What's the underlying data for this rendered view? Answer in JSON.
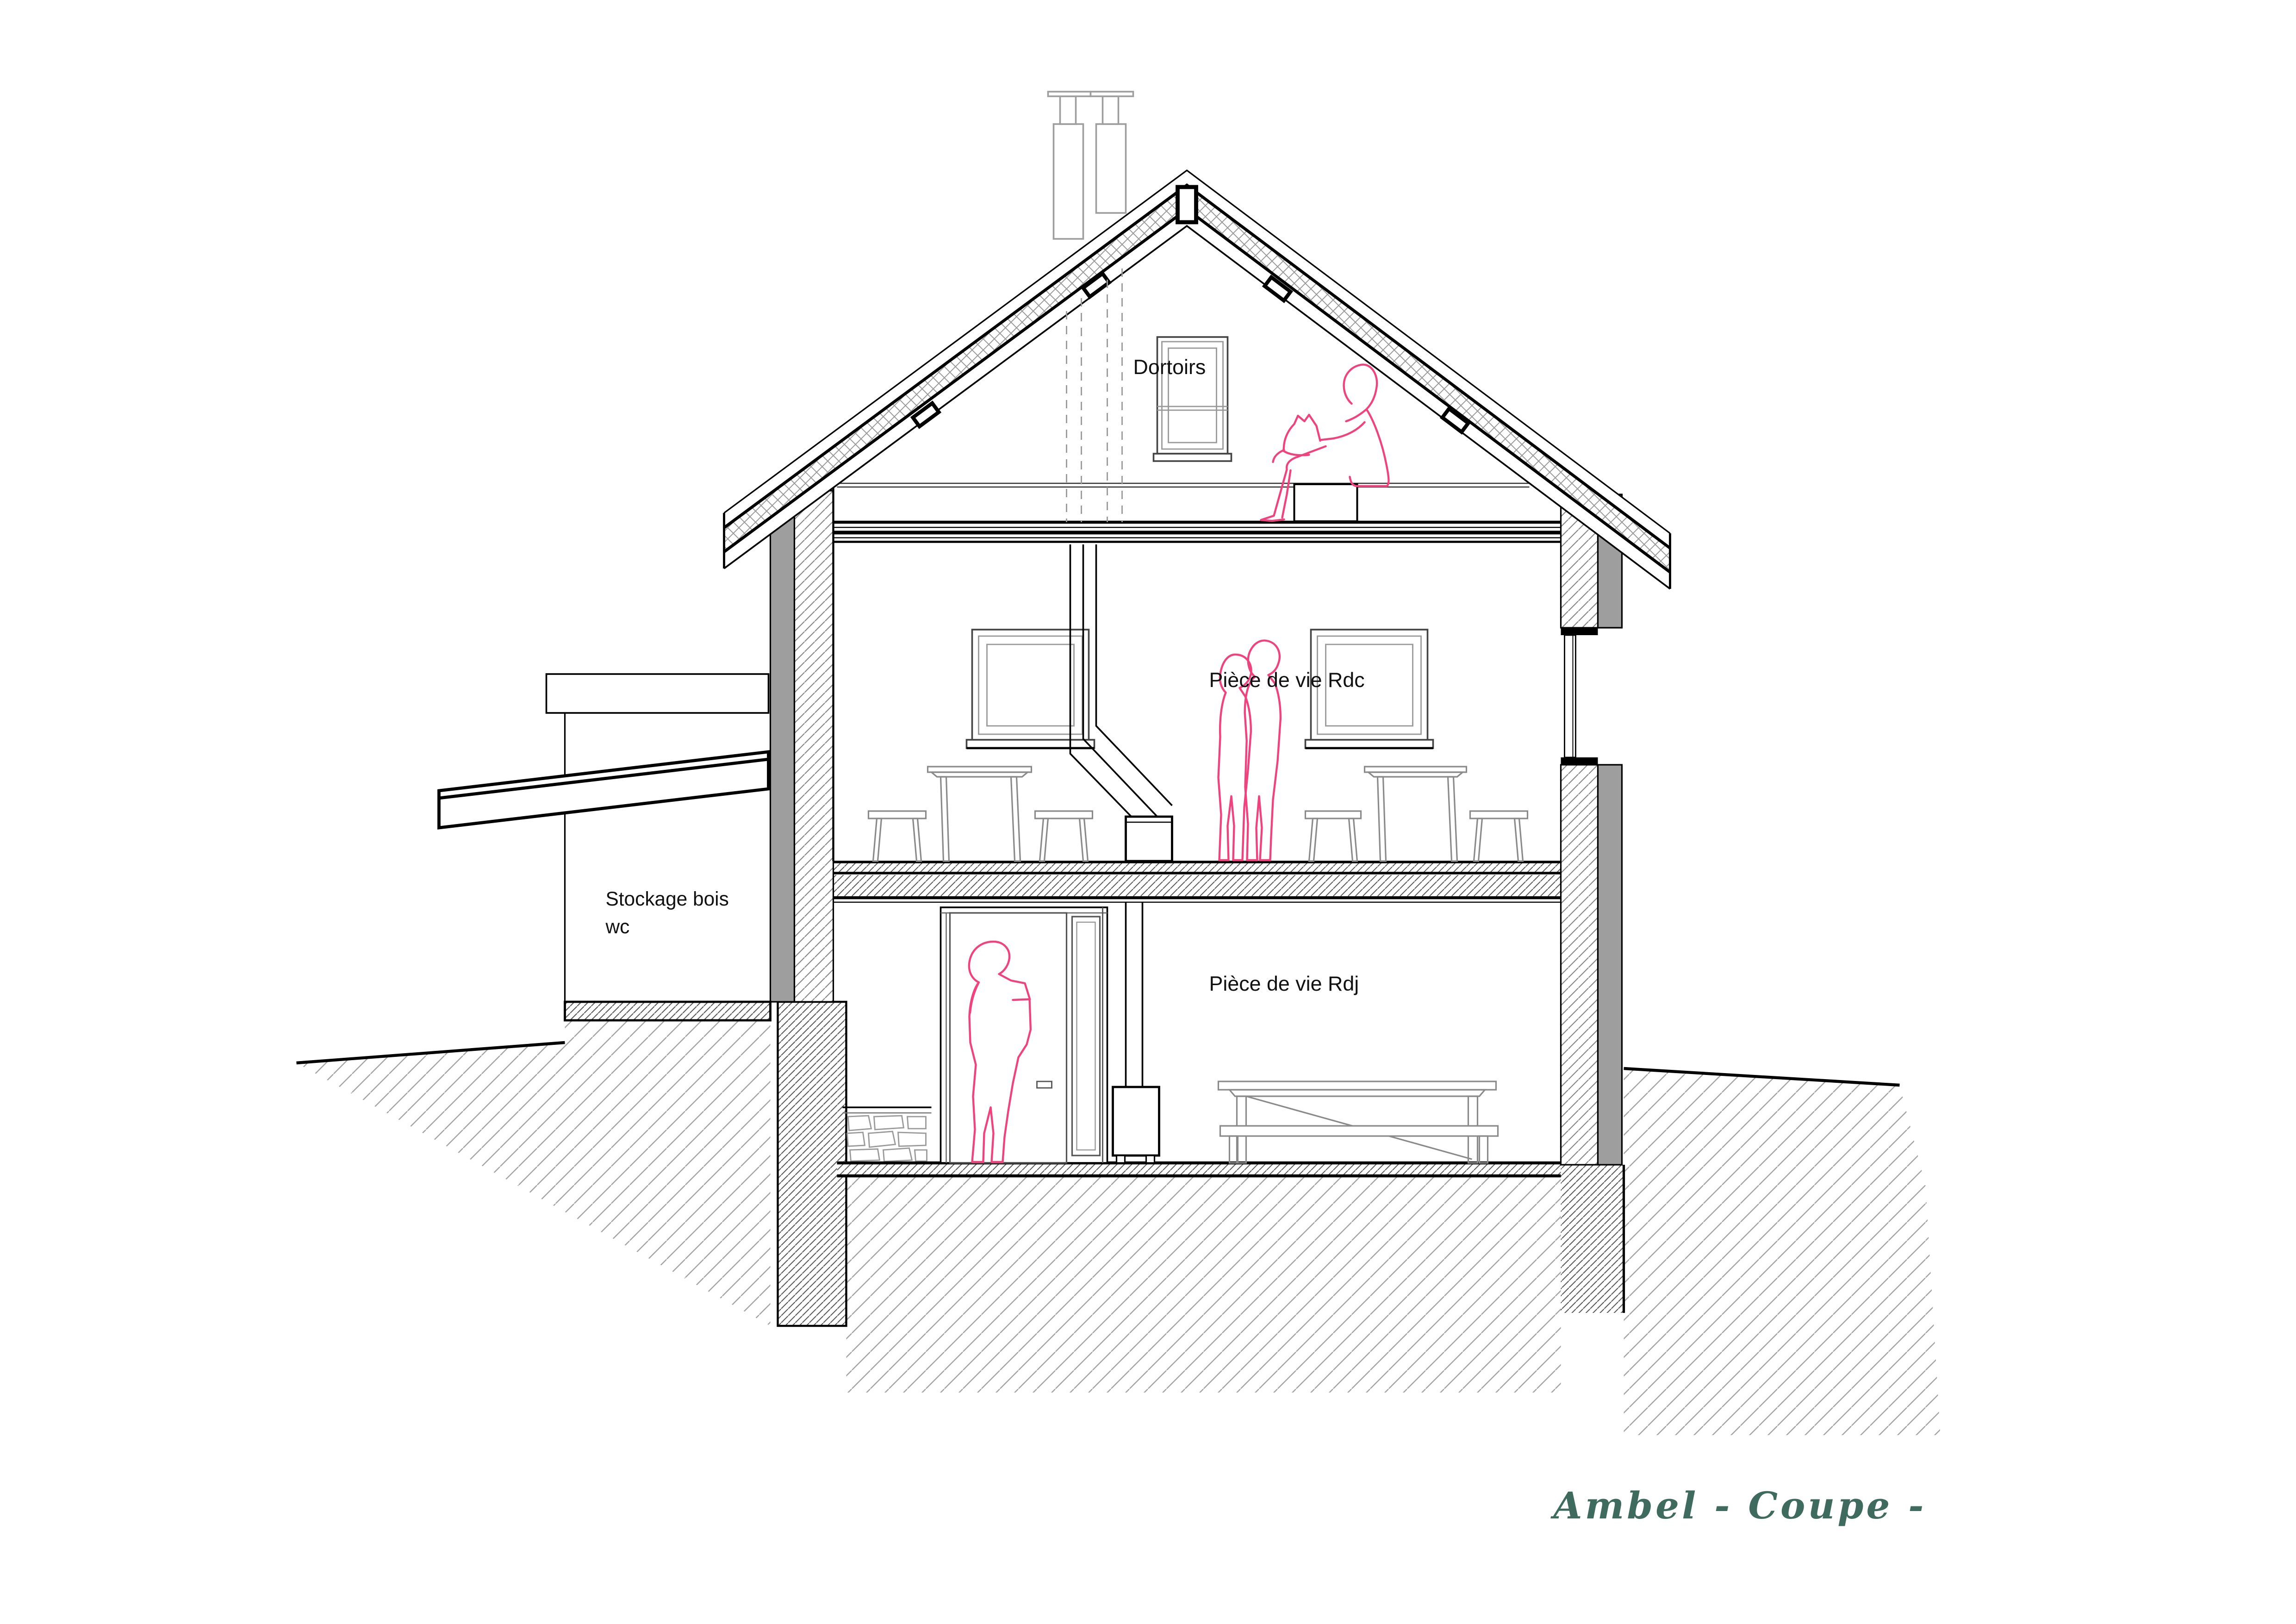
{
  "title": {
    "text": "Ambel  - Coupe -"
  },
  "labels": {
    "dortoirs": "Dortoirs",
    "piece_de_vie_rdc": "Pièce de vie Rdc",
    "piece_de_vie_rdj": "Pièce de vie Rdj",
    "stockage_line1": "Stockage bois",
    "stockage_line2": "wc"
  },
  "colors": {
    "figure_pink": "#f0437e",
    "title_teal": "#3f6b5f",
    "wall_gray": "#9e9e9e",
    "hatch_gray": "#999999",
    "line_black": "#111111",
    "background": "#ffffff"
  }
}
